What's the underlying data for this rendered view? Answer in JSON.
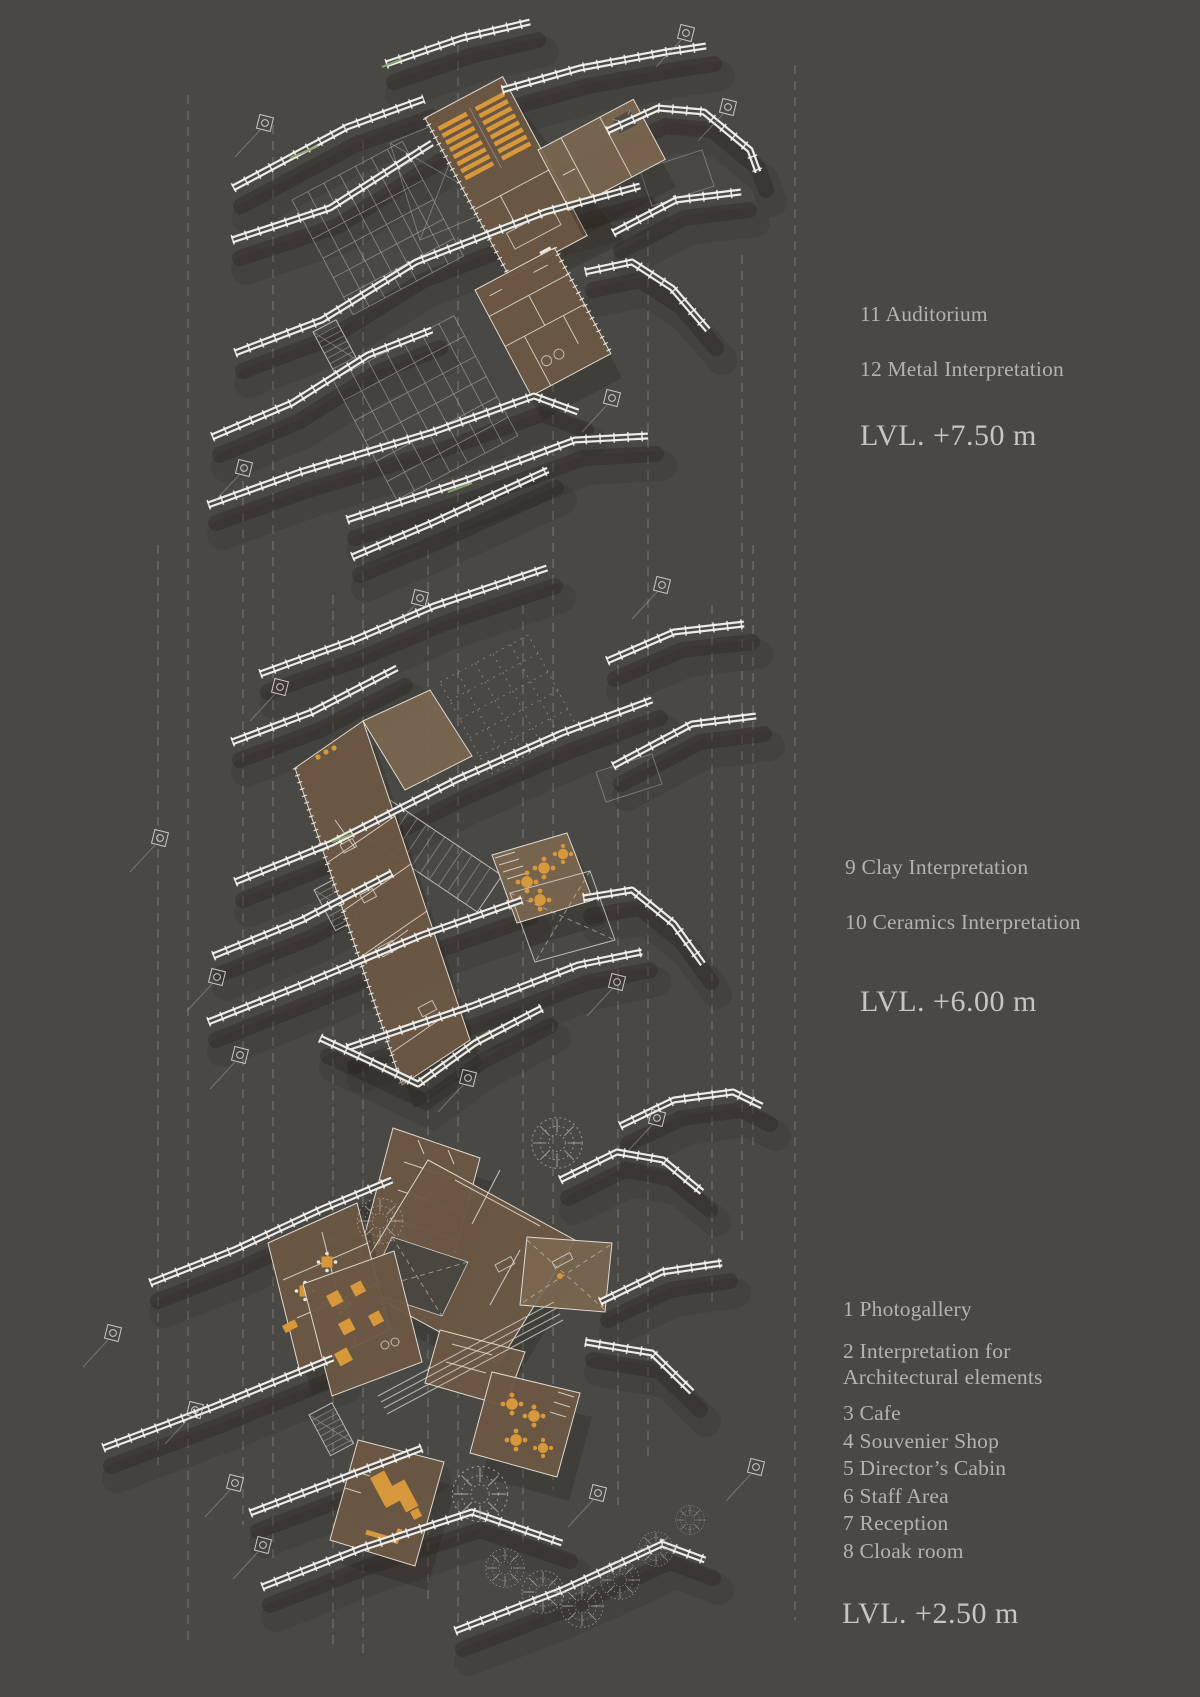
{
  "diagram_title": "Exploded axonometric floor plans",
  "colors": {
    "background": "#4a4844",
    "wall_white": "#ecebe6",
    "floor_brown": "#6c5743",
    "floor_brown_light": "#7c6750",
    "furniture_orange": "#d7983b",
    "dashed_gray": "#8f8d88",
    "label_text": "#b4b2ad",
    "level_text": "#c7c5c0",
    "accent_green": "#8aa973"
  },
  "levels": [
    {
      "level_label": "LVL. +7.50 m",
      "items": [
        "11 Auditorium",
        "12 Metal Interpretation"
      ]
    },
    {
      "level_label": "LVL. +6.00 m",
      "items": [
        "9 Clay Interpretation",
        "10 Ceramics Interpretation"
      ]
    },
    {
      "level_label": "LVL. +2.50 m",
      "items": [
        "1 Photogallery",
        "2 Interpretation for Architectural elements",
        "3 Cafe",
        "4 Souvenier Shop",
        "5 Director’s Cabin",
        "6 Staff Area",
        "7 Reception",
        "8 Cloak room"
      ]
    }
  ]
}
